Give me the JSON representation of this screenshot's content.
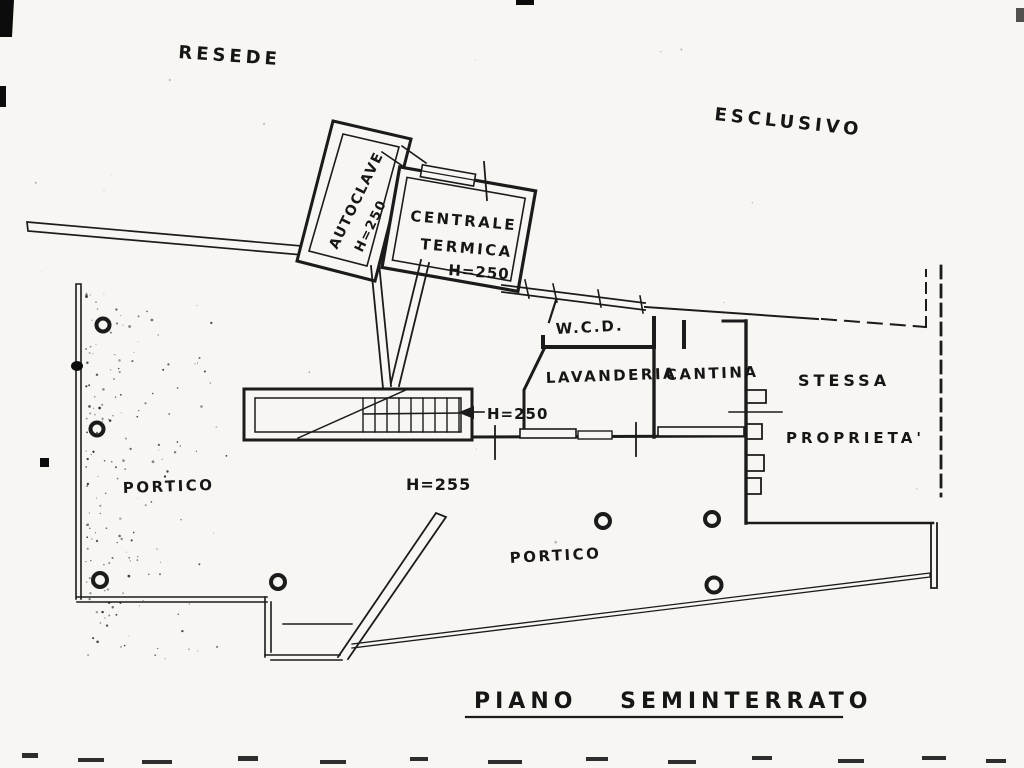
{
  "page": {
    "paper_color": "#f7f6f2",
    "ink_color": "#1a1a1a"
  },
  "outside_labels": {
    "resede": "RESEDE",
    "esclusivo": "ESCLUSIVO"
  },
  "rooms": {
    "autoclave": {
      "label": "AUTOCLAVE",
      "height": "H=250"
    },
    "centrale_termica": {
      "name_line1": "CENTRALE",
      "name_line2": "TERMICA",
      "height": "H=250"
    },
    "wcd": {
      "label": "W.C.D."
    },
    "lavanderia": {
      "label": "LAVANDERIA"
    },
    "cantina": {
      "label": "CANTINA"
    },
    "portico_left": {
      "label": "PORTICO"
    },
    "portico_bottom": {
      "label": "PORTICO"
    }
  },
  "dimensions": {
    "stair_height": "H=250",
    "hall_height": "H=255"
  },
  "boundary_notes": {
    "line1": "STESSA",
    "line2": "PROPRIETA'"
  },
  "title": {
    "text": "PIANO SEMINTERRATO"
  }
}
